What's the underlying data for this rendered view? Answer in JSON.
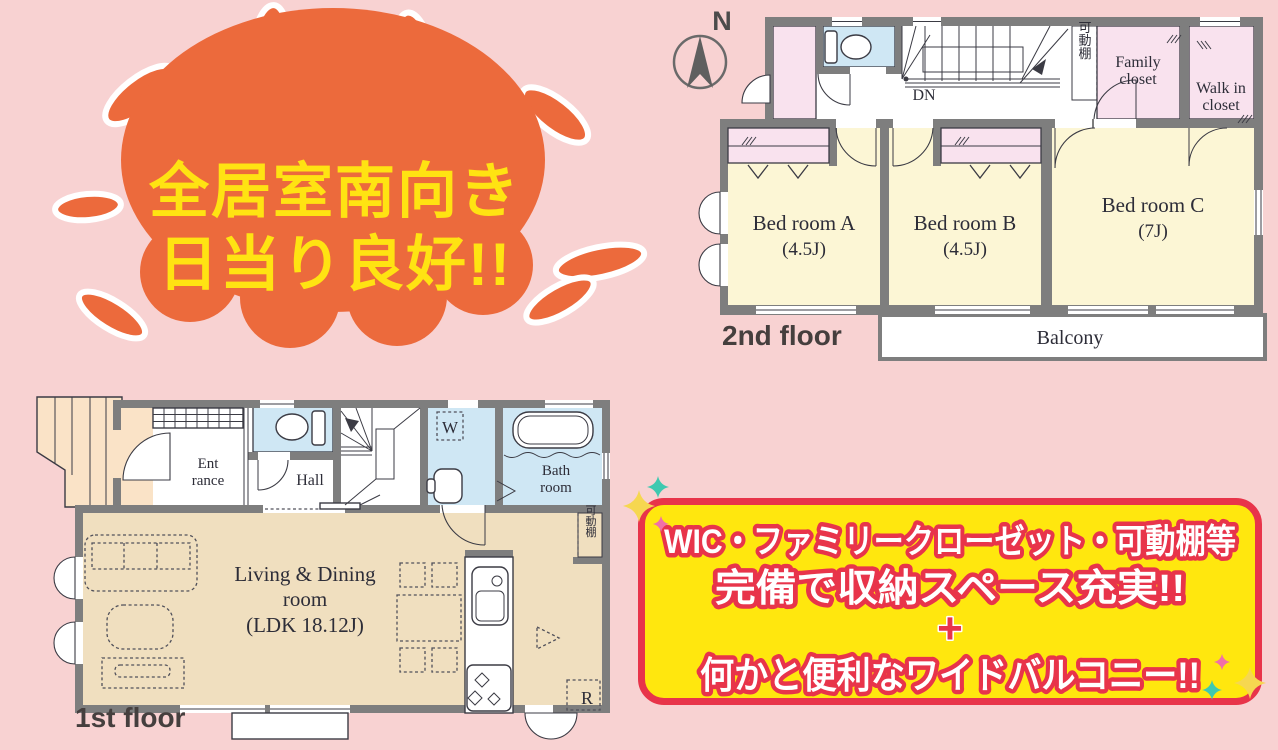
{
  "sun": {
    "line1": "全居室南向き",
    "line2": "日当り良好!!"
  },
  "compass": {
    "label": "N"
  },
  "floor2": {
    "label": "2nd floor",
    "bedroomA": {
      "name": "Bed room A",
      "size": "(4.5J)"
    },
    "bedroomB": {
      "name": "Bed room B",
      "size": "(4.5J)"
    },
    "bedroomC": {
      "name": "Bed room C",
      "size": "(7J)"
    },
    "family_closet": {
      "line1": "Family",
      "line2": "closet"
    },
    "walk_in_closet": {
      "line1": "Walk in",
      "line2": "closet"
    },
    "shelf": "可動棚",
    "stairs_dn": "DN",
    "balcony": "Balcony"
  },
  "floor1": {
    "label": "1st floor",
    "entrance": {
      "line1": "Ent",
      "line2": "rance"
    },
    "hall": "Hall",
    "bath": {
      "line1": "Bath",
      "line2": "room"
    },
    "washer": "W",
    "fridge": "R",
    "shelf": "可動棚",
    "living": {
      "line1": "Living & Dining",
      "line2": "room",
      "line3": "(LDK 18.12J)"
    }
  },
  "banner": {
    "line1": "WIC・ファミリークローゼット・可動棚等",
    "line2": "完備で収納スペース充実!!",
    "plus": "+",
    "line3": "何かと便利なワイドバルコニー!!"
  },
  "colors": {
    "background_pink": "#f8d2d2",
    "sun_orange": "#ec6a3c",
    "sun_text_yellow": "#ffe312",
    "banner_yellow": "#ffe70e",
    "banner_red": "#e8344a",
    "room_yellow": "#fcf6d5",
    "closet_pink": "#f9e2ee",
    "water_blue": "#cfe7f4",
    "living_tan": "#f0dfbf",
    "porch_peach": "#fae3c7",
    "wall_gray": "#7e7e7e",
    "sparkle_teal": "#3fc9b0",
    "sparkle_pink": "#f070a8",
    "sparkle_yellow": "#f6d750"
  }
}
